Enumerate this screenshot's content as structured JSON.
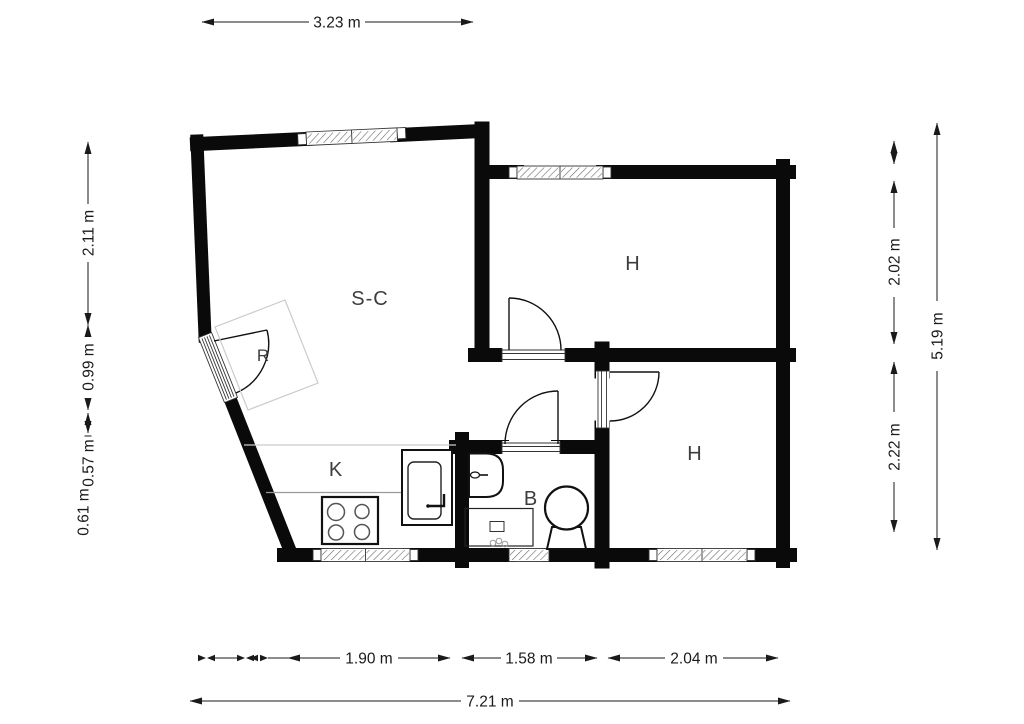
{
  "rooms": {
    "living_label": "S-C",
    "bedroom_top_label": "H",
    "bedroom_bottom_label": "H",
    "kitchen_label": "K",
    "bathroom_label": "B",
    "entry_label": "R"
  },
  "dimensions": {
    "top_width": "3.23 m",
    "left_upper": "2.11 m",
    "left_mid": "0.99 m",
    "left_lower": "0.57 m",
    "left_bottom": "0.61 m",
    "right_room_top": "2.02 m",
    "right_room_bottom": "2.22 m",
    "right_total": "5.19 m",
    "bottom_kitchen": "1.90 m",
    "bottom_bath": "1.58 m",
    "bottom_bedroom": "2.04 m",
    "bottom_total": "7.21 m"
  },
  "colors": {
    "wall": "#0a0a0a",
    "dimension_line": "#1a1a1a",
    "room_label": "#3d3d3d",
    "furniture_outline": "#cccccc",
    "counter_line": "#999999",
    "background": "#ffffff"
  }
}
